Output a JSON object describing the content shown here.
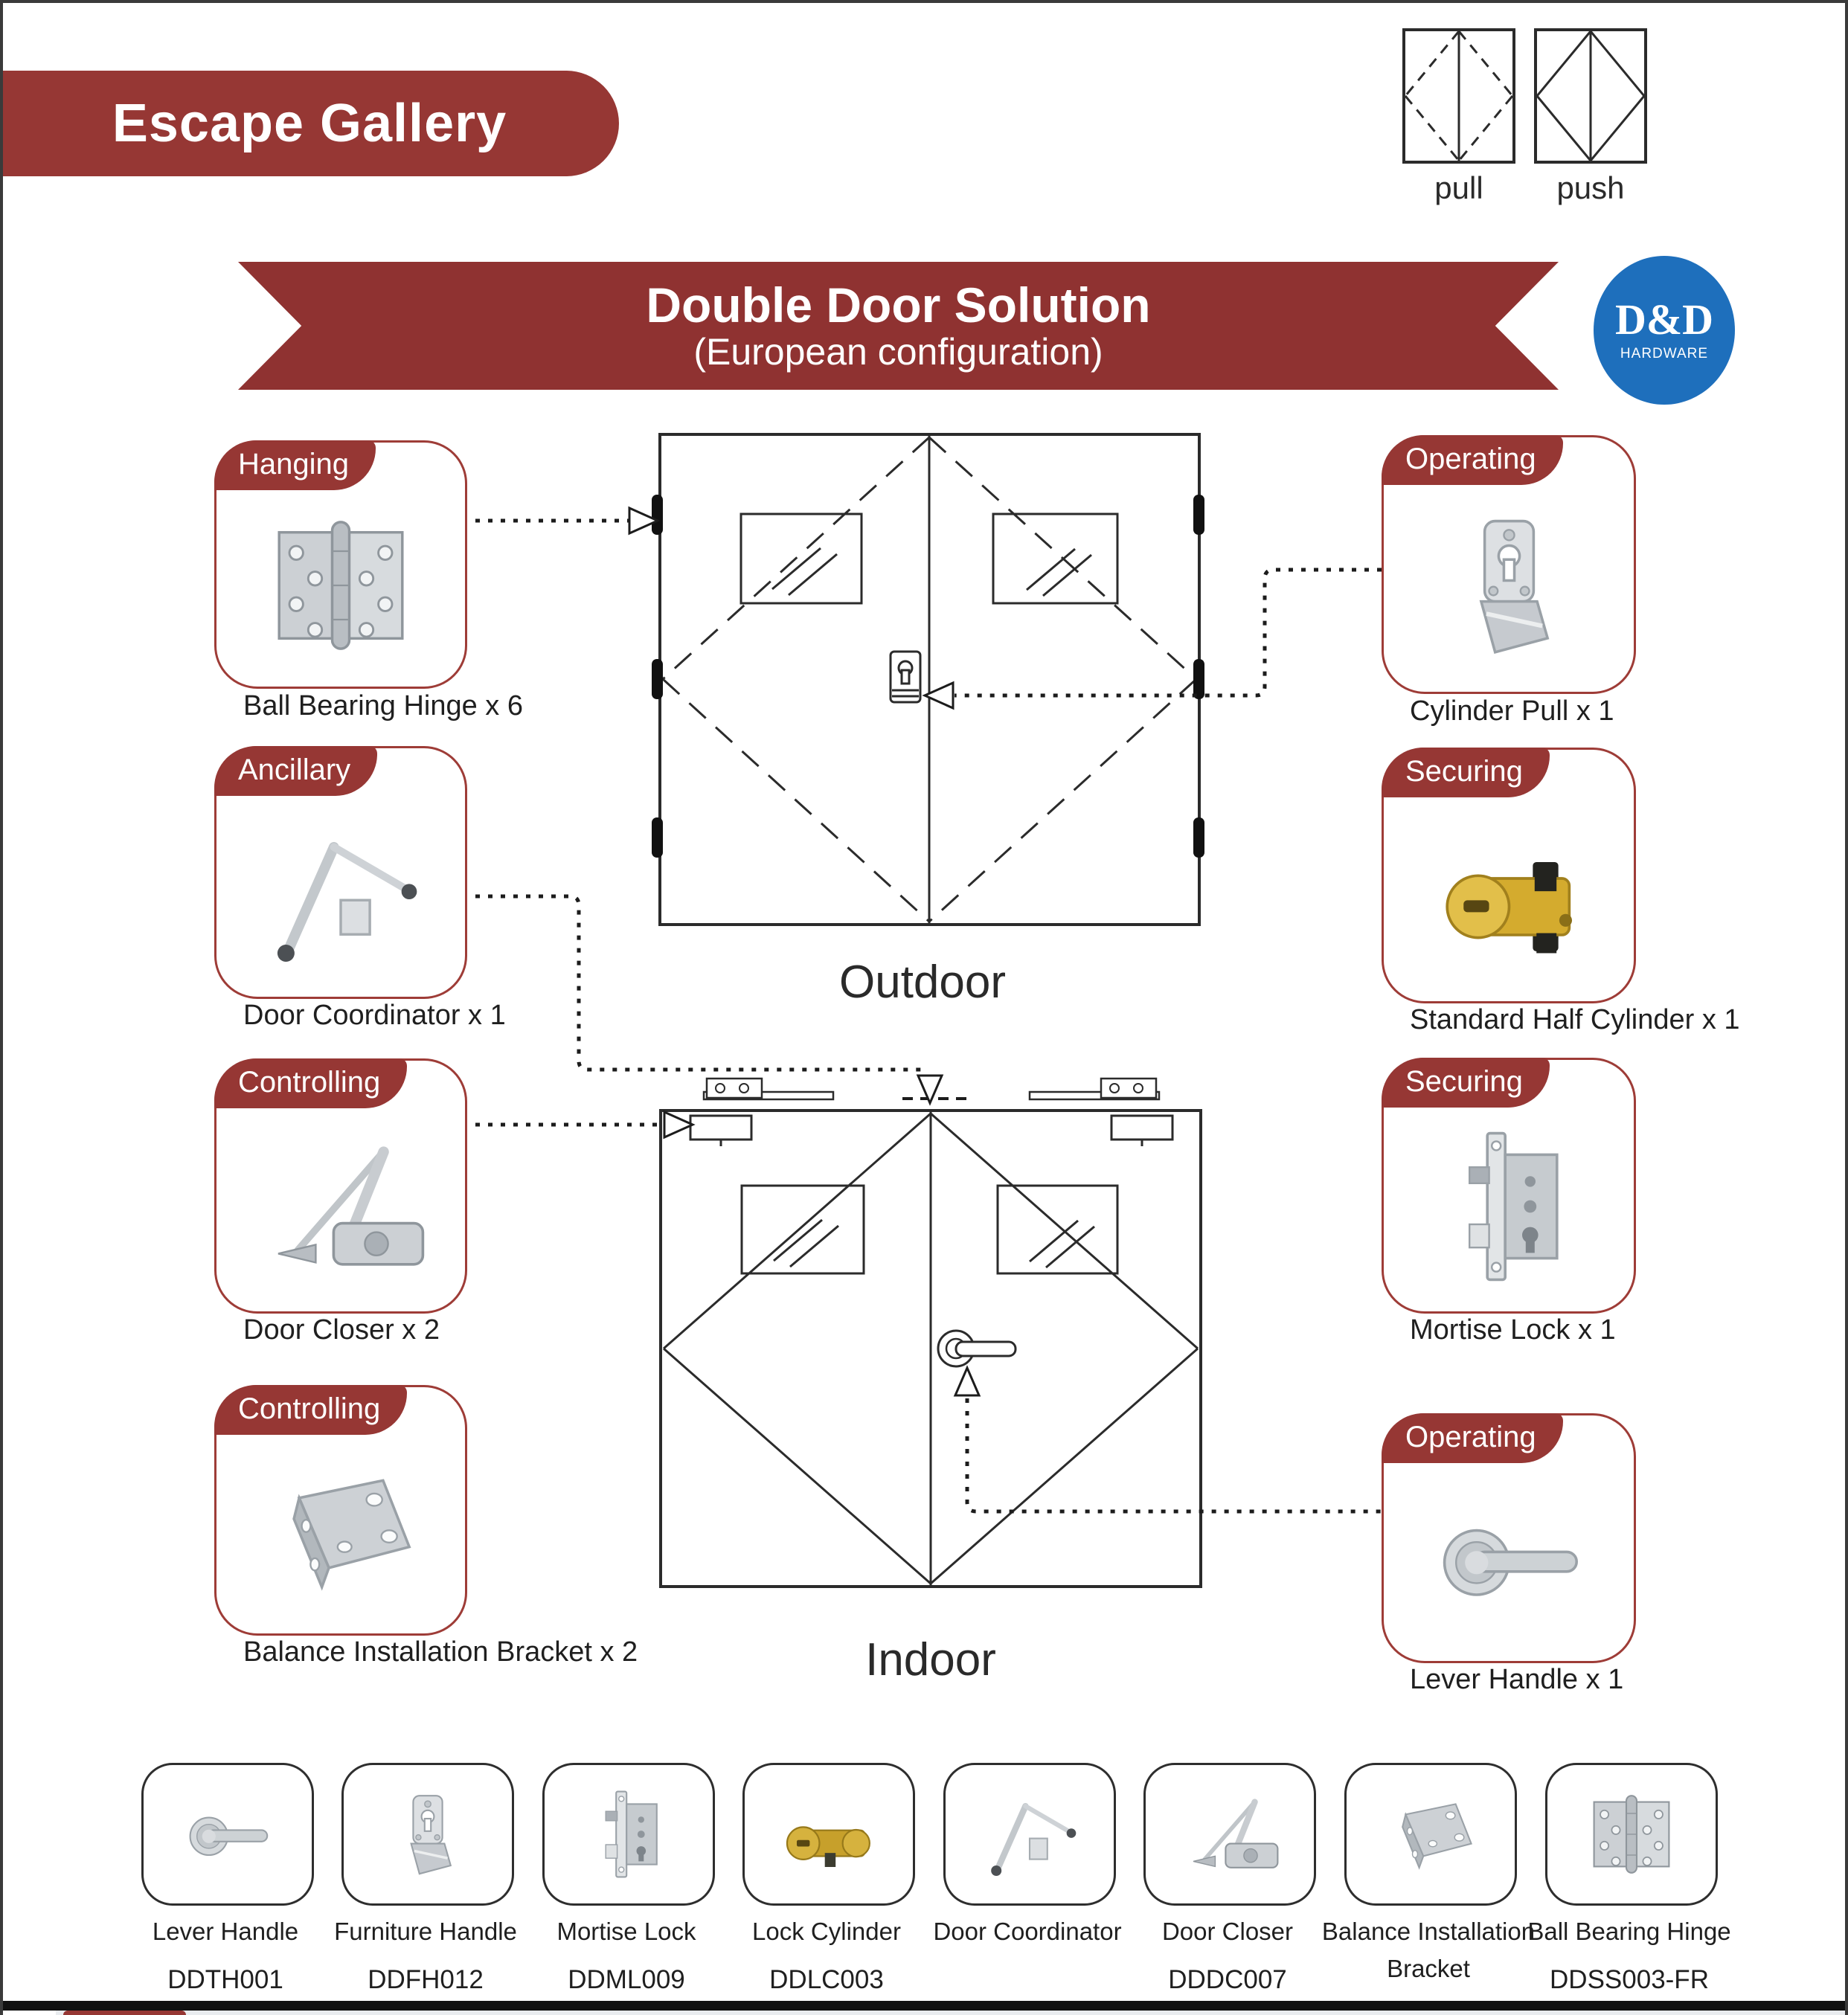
{
  "banner": {
    "title": "Escape Gallery"
  },
  "legend": {
    "pull_label": "pull",
    "push_label": "push"
  },
  "ribbon": {
    "title": "Double Door Solution",
    "subtitle": "(European configuration)"
  },
  "logo": {
    "name": "D&D",
    "subtitle": "HARDWARE"
  },
  "doors": {
    "outdoor_label": "Outdoor",
    "indoor_label": "Indoor"
  },
  "colors": {
    "maroon": "#963734",
    "logo_blue": "#1e6fbc",
    "line": "#2b2b2b",
    "brass": "#d4ab2e"
  },
  "callouts": {
    "left": [
      {
        "tag": "Hanging",
        "label": "Ball Bearing Hinge x 6",
        "product": "ball-bearing-hinge"
      },
      {
        "tag": "Ancillary",
        "label": "Door Coordinator x 1",
        "product": "door-coordinator"
      },
      {
        "tag": "Controlling",
        "label": "Door Closer x 2",
        "product": "door-closer"
      },
      {
        "tag": "Controlling",
        "label": "Balance Installation Bracket x 2",
        "product": "balance-installation-bracket"
      }
    ],
    "right": [
      {
        "tag": "Operating",
        "label": "Cylinder Pull  x 1",
        "product": "cylinder-pull"
      },
      {
        "tag": "Securing",
        "label": "Standard Half Cylinder x 1",
        "product": "standard-half-cylinder"
      },
      {
        "tag": "Securing",
        "label": "Mortise Lock x 1",
        "product": "mortise-lock"
      },
      {
        "tag": "Operating",
        "label": "Lever Handle x 1",
        "product": "lever-handle"
      }
    ]
  },
  "catalog": [
    {
      "name": "Lever Handle",
      "code": "DDTH001"
    },
    {
      "name": "Furniture Handle",
      "code": "DDFH012"
    },
    {
      "name": "Mortise Lock",
      "code": "DDML009"
    },
    {
      "name": "Lock Cylinder",
      "code": "DDLC003"
    },
    {
      "name": "Door Coordinator",
      "code": ""
    },
    {
      "name": "Door Closer",
      "code": "DDDC007"
    },
    {
      "name": "Balance Installation Bracket",
      "code": ""
    },
    {
      "name": "Ball Bearing Hinge",
      "code": "DDSS003-FR"
    }
  ]
}
